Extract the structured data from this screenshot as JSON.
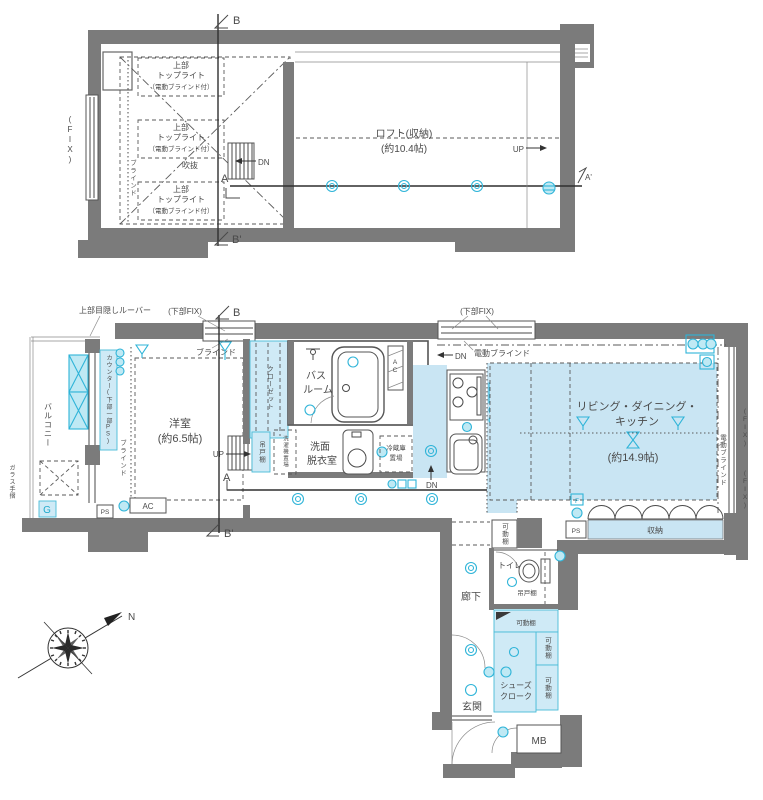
{
  "colors": {
    "wall": "#7b7b7b",
    "accent_cyan": "#1fa9cc",
    "room_fill": "#c9e5f3",
    "shelf_fill": "#cfeaf6",
    "line": "#4a4a4a"
  },
  "loft_plan": {
    "marker_b": "B",
    "marker_b_prime": "B'",
    "marker_a": "A",
    "marker_a_prime": "A'",
    "fix_window": "(FIX)",
    "toplight_line1": "上部",
    "toplight_line2": "トップライト",
    "toplight_line3": "（電動ブラインド付）",
    "void": "吹抜",
    "blind": "ブラインド",
    "down": "DN",
    "up": "UP",
    "name": "ロフト(収納)",
    "size": "(約10.4帖)"
  },
  "main_plan": {
    "louver": "上部目隠しルーバー",
    "lower_fix": "(下部FIX)",
    "blind": "ブラインド",
    "marker_b": "B",
    "marker_b_prime": "B'",
    "marker_a": "A",
    "marker_a_prime": "A'",
    "balcony": "バルコニー",
    "glass_rail": "ガラス手摺",
    "gas": "G",
    "counter_ps": "カウンター(下部一部PS)",
    "west_room_name": "洋室",
    "west_room_size": "(約6.5帖)",
    "ac": "AC",
    "ps": "PS",
    "up": "UP",
    "down": "DN",
    "closet": "クローゼット",
    "bath_line1": "バス",
    "bath_line2": "ルーム",
    "wash_line1": "洗面",
    "wash_line2": "脱衣室",
    "hanging_shelf": "吊戸棚",
    "washer": "洗濯機置場",
    "fridge_line1": "冷蔵庫",
    "fridge_line2": "置場",
    "motor_blind": "電動ブラインド",
    "ldk_line1": "リビング・ダイニング・",
    "ldk_line2": "キッチン",
    "ldk_size": "(約14.9帖)",
    "counter_under": "(カウンター下)",
    "fix_window": "(FIX)",
    "storage": "収納",
    "fan": "F",
    "hallway": "廊下",
    "toilet": "トイレ",
    "movable_shelf": "可動棚",
    "shoes_line1": "シューズ",
    "shoes_line2": "クローク",
    "entrance": "玄関",
    "meter_box": "MB",
    "north": "N"
  }
}
